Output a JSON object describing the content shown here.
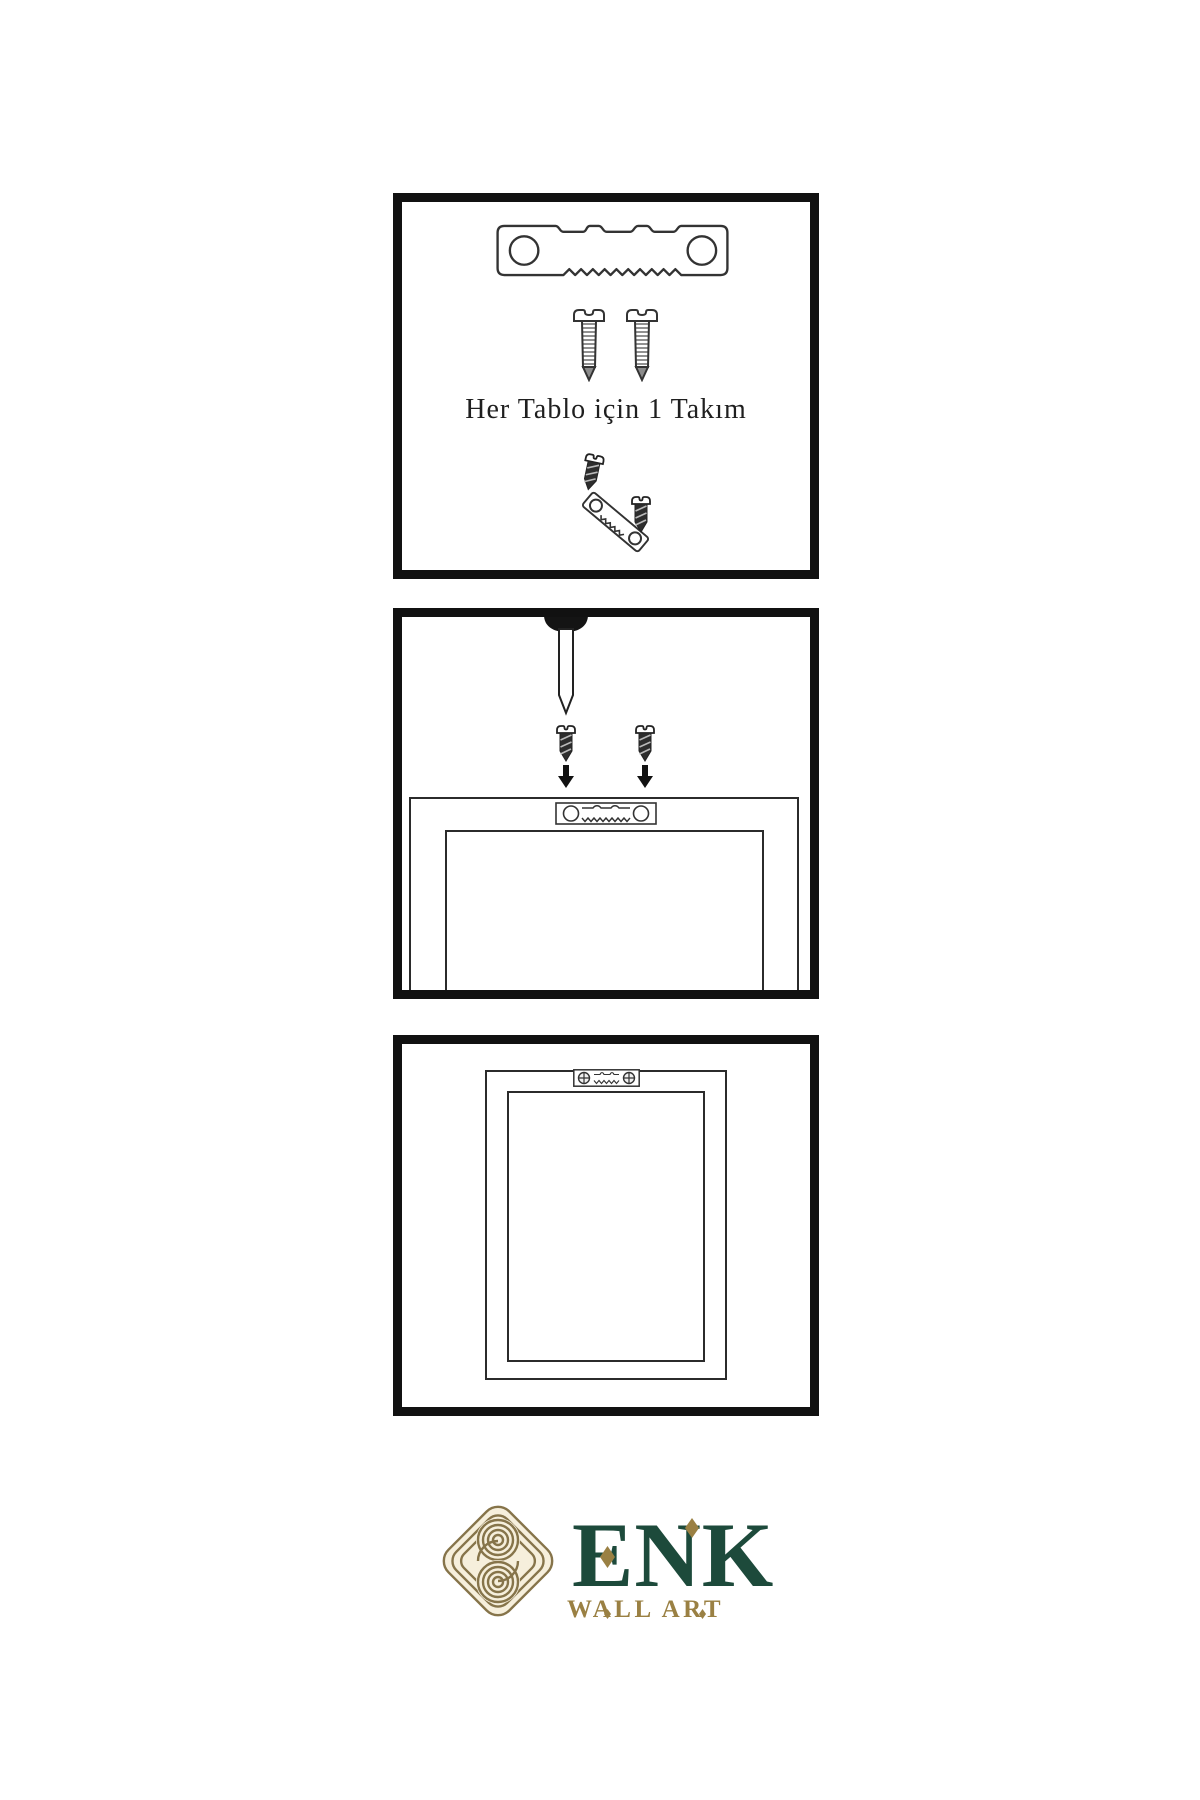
{
  "theme": {
    "brand_green": "#1d4a3b",
    "brand_gold": "#9a8043",
    "knot_gold": "#86744a",
    "knot_cream": "#f6efdc",
    "line": "#2b2b2b",
    "panel_border": "#111111",
    "page_bg": "#ffffff"
  },
  "step1": {
    "caption": "Her Tablo için 1 Takım"
  },
  "brand": {
    "name": "ENK",
    "tagline": "WALL ART"
  },
  "icons": {
    "sawtooth_hanger": "svg-plate-with-holes-and-teeth",
    "screw": "svg-outline-screw",
    "dark_screw": "svg-dark-screw",
    "nail": "svg-nail",
    "arrow_down": "svg-solid-arrow",
    "knot_logo": "svg-interlaced-knot",
    "diamond": "css-rhombus"
  }
}
